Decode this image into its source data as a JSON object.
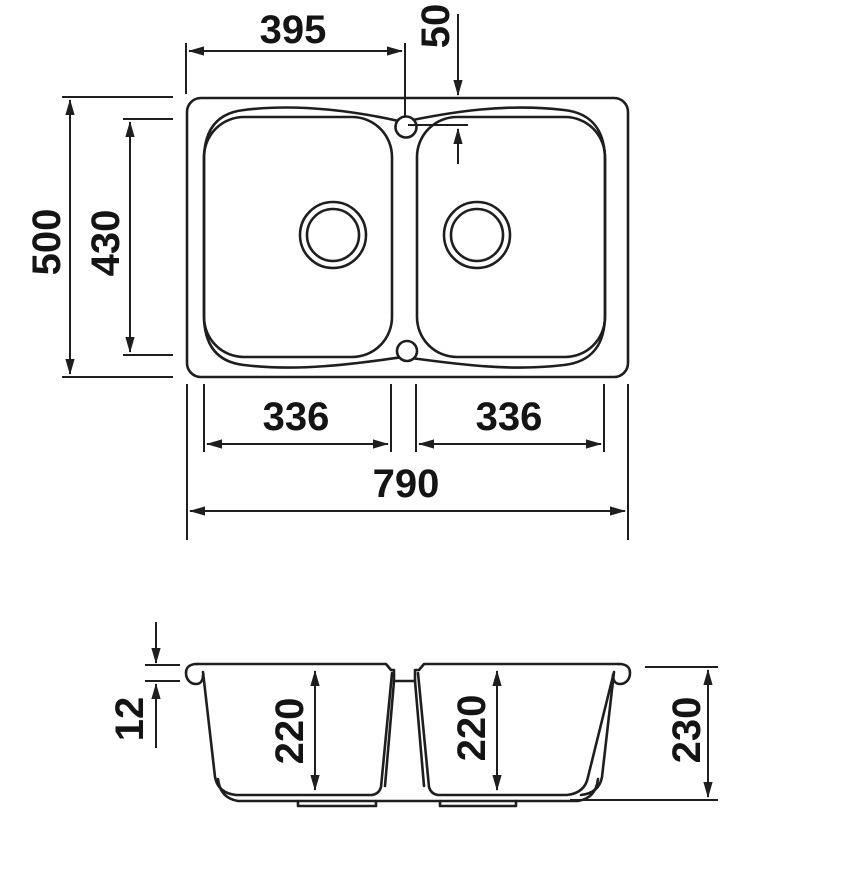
{
  "drawing": {
    "subject": "double-bowl sink technical drawing, plan view and section view",
    "line_color": "#1e1e1e",
    "background_color": "#ffffff"
  },
  "plan_view": {
    "width_to_tap": "395",
    "tap_offset": "50",
    "overall_depth": "500",
    "inner_depth": "430",
    "bowl_width_left": "336",
    "bowl_width_right": "336",
    "overall_width": "790"
  },
  "section_view": {
    "edge_thickness": "12",
    "bowl_depth_left": "220",
    "bowl_depth_right": "220",
    "overall_height": "230"
  }
}
